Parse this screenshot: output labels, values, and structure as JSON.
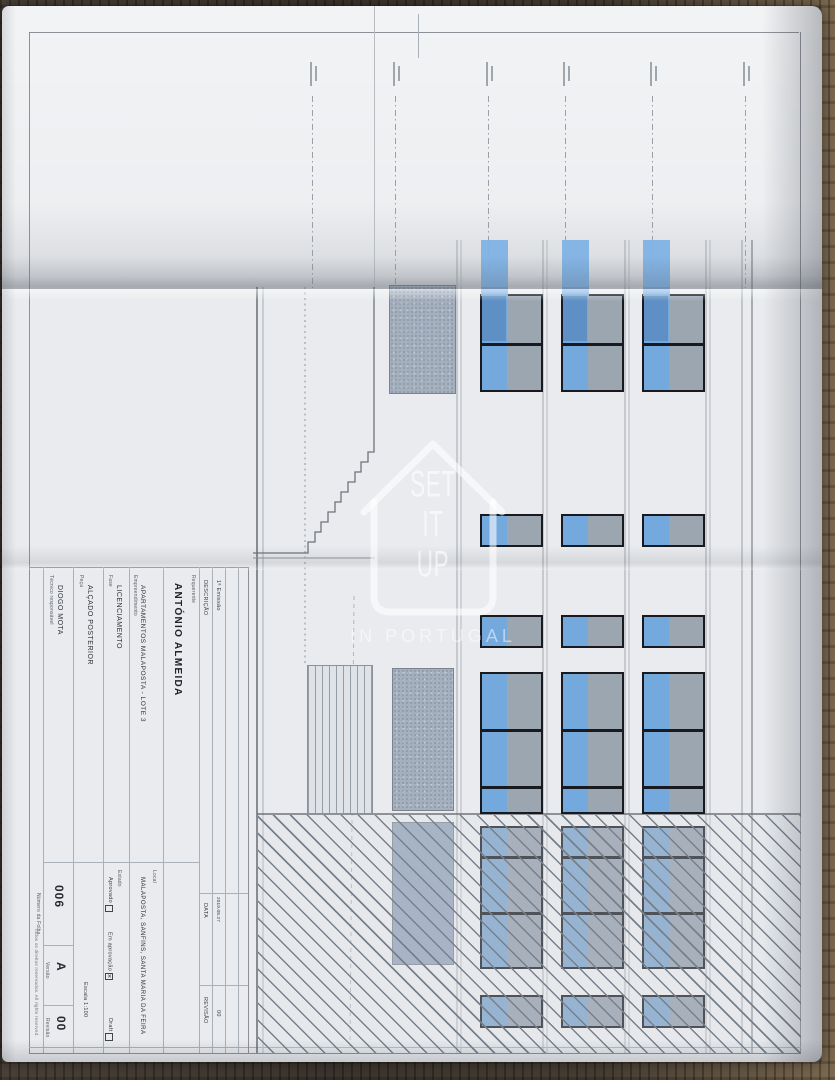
{
  "title_block": {
    "requerente": {
      "label": "Requerente",
      "value": "ANTÓNIO ALMEIDA"
    },
    "empreendimento": {
      "label": "Empreendimento",
      "value": "APARTAMENTOS MALAPOSTA - LOTE 3"
    },
    "fase": {
      "label": "Fase",
      "value": "LICENCIAMENTO"
    },
    "peca": {
      "label": "Peça",
      "value": "ALÇADO POSTERIOR"
    },
    "tecnico": {
      "label": "Técnico responsável",
      "value": "DIOGO MOTA"
    },
    "local": {
      "label": "Local",
      "value": "MALAPOSTA, SANFINS, SANTA MARIA DA FEIRA"
    },
    "estado": {
      "label": "Estado",
      "options": [
        {
          "label": "Aprovado",
          "checked": false
        },
        {
          "label": "Em aprovação",
          "checked": true
        },
        {
          "label": "Draft",
          "checked": false
        }
      ]
    },
    "escala": {
      "label": "Escala",
      "value": "1:100"
    },
    "folha": {
      "label": "Número da Folha",
      "value": "006"
    },
    "versao": {
      "label": "Versão",
      "value": "A"
    },
    "revisao": {
      "label": "Revisão",
      "value": "00"
    },
    "copyright": "Todos os direitos reservados. All rights reserved.",
    "revision_table": {
      "descricao_header": "DESCRIÇÃO",
      "data_header": "DATA",
      "revisao_header": "REVISÃO",
      "entry": {
        "descricao": "1ª Emissão",
        "data": "2019.08.27",
        "revisao": "00"
      }
    }
  },
  "watermark": {
    "line1": "SET",
    "line2": "IT",
    "line3": "UP",
    "tagline": "IN PORTUGAL"
  },
  "drawing": {
    "title": "ALÇADO POSTERIOR",
    "level_annotations": {
      "count": 6,
      "legible": false
    },
    "elevation": {
      "columns": [
        {
          "x": 478
        },
        {
          "x": 559
        },
        {
          "x": 640
        }
      ],
      "column_width": 63,
      "blue_pane_width": 25,
      "bays": [
        {
          "y": 288,
          "h": 98,
          "dividers": [
            337
          ],
          "strip": true,
          "hatched": false
        },
        {
          "y": 508,
          "h": 33,
          "dividers": [],
          "strip": false,
          "hatched": false
        },
        {
          "y": 609,
          "h": 33,
          "dividers": [],
          "strip": false,
          "hatched": false
        },
        {
          "y": 666,
          "h": 142,
          "dividers": [
            723,
            780
          ],
          "strip": false,
          "hatched": false
        },
        {
          "y": 820,
          "h": 143,
          "dividers": [
            850,
            906
          ],
          "strip": false,
          "hatched": true
        },
        {
          "y": 989,
          "h": 33,
          "dividers": [],
          "strip": false,
          "hatched": true
        }
      ]
    },
    "colors": {
      "glass_blue": "#74a9de",
      "rail_blue": "#7fb2e4",
      "pane_gray": "#9ca6b1",
      "frame_dark": "#181a20",
      "hatch_line": "#4e5a68",
      "paper": "#e9ebee"
    }
  }
}
